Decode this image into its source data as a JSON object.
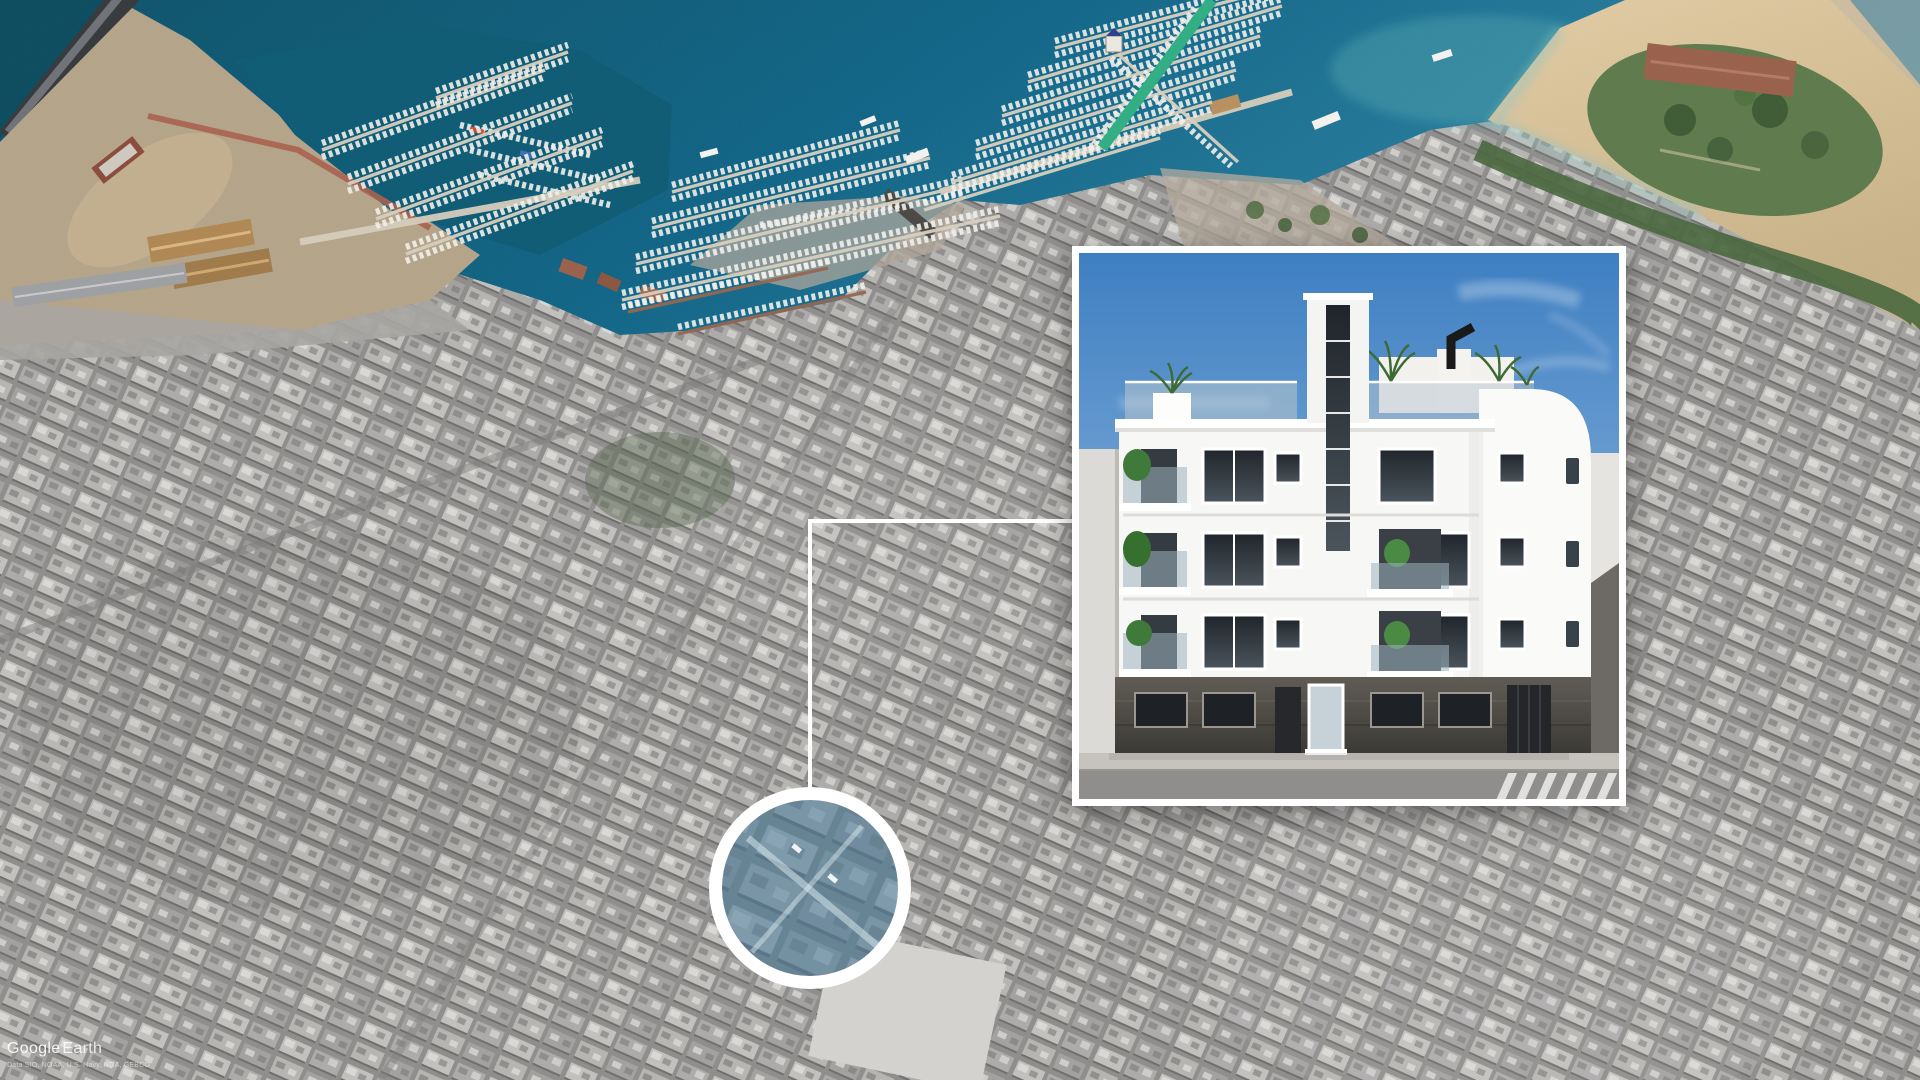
{
  "watermark": {
    "brand_primary": "Google",
    "brand_secondary": "Earth",
    "attribution": "Data SIO, NOAA, U.S. Navy, NGA, GEBCO"
  },
  "colors": {
    "sky_top": "#3e7fc2",
    "sky_bottom": "#a9c9e6",
    "sea_deep": "#0c5168",
    "sea_mid": "#0f6486",
    "sea_light": "#2e84a4",
    "sand_light": "#e2cca4",
    "sand_dark": "#c9b288",
    "park_green": "#5d7a4b",
    "pier_green": "#2fae83",
    "city_gray": "#9a9a9a",
    "highlight_tint": "#4c7d9d",
    "ring_white": "#ffffff",
    "building_white": "#f7f7f5",
    "ground_dark": "#3c3a36",
    "callout_line": "#ffffff"
  }
}
